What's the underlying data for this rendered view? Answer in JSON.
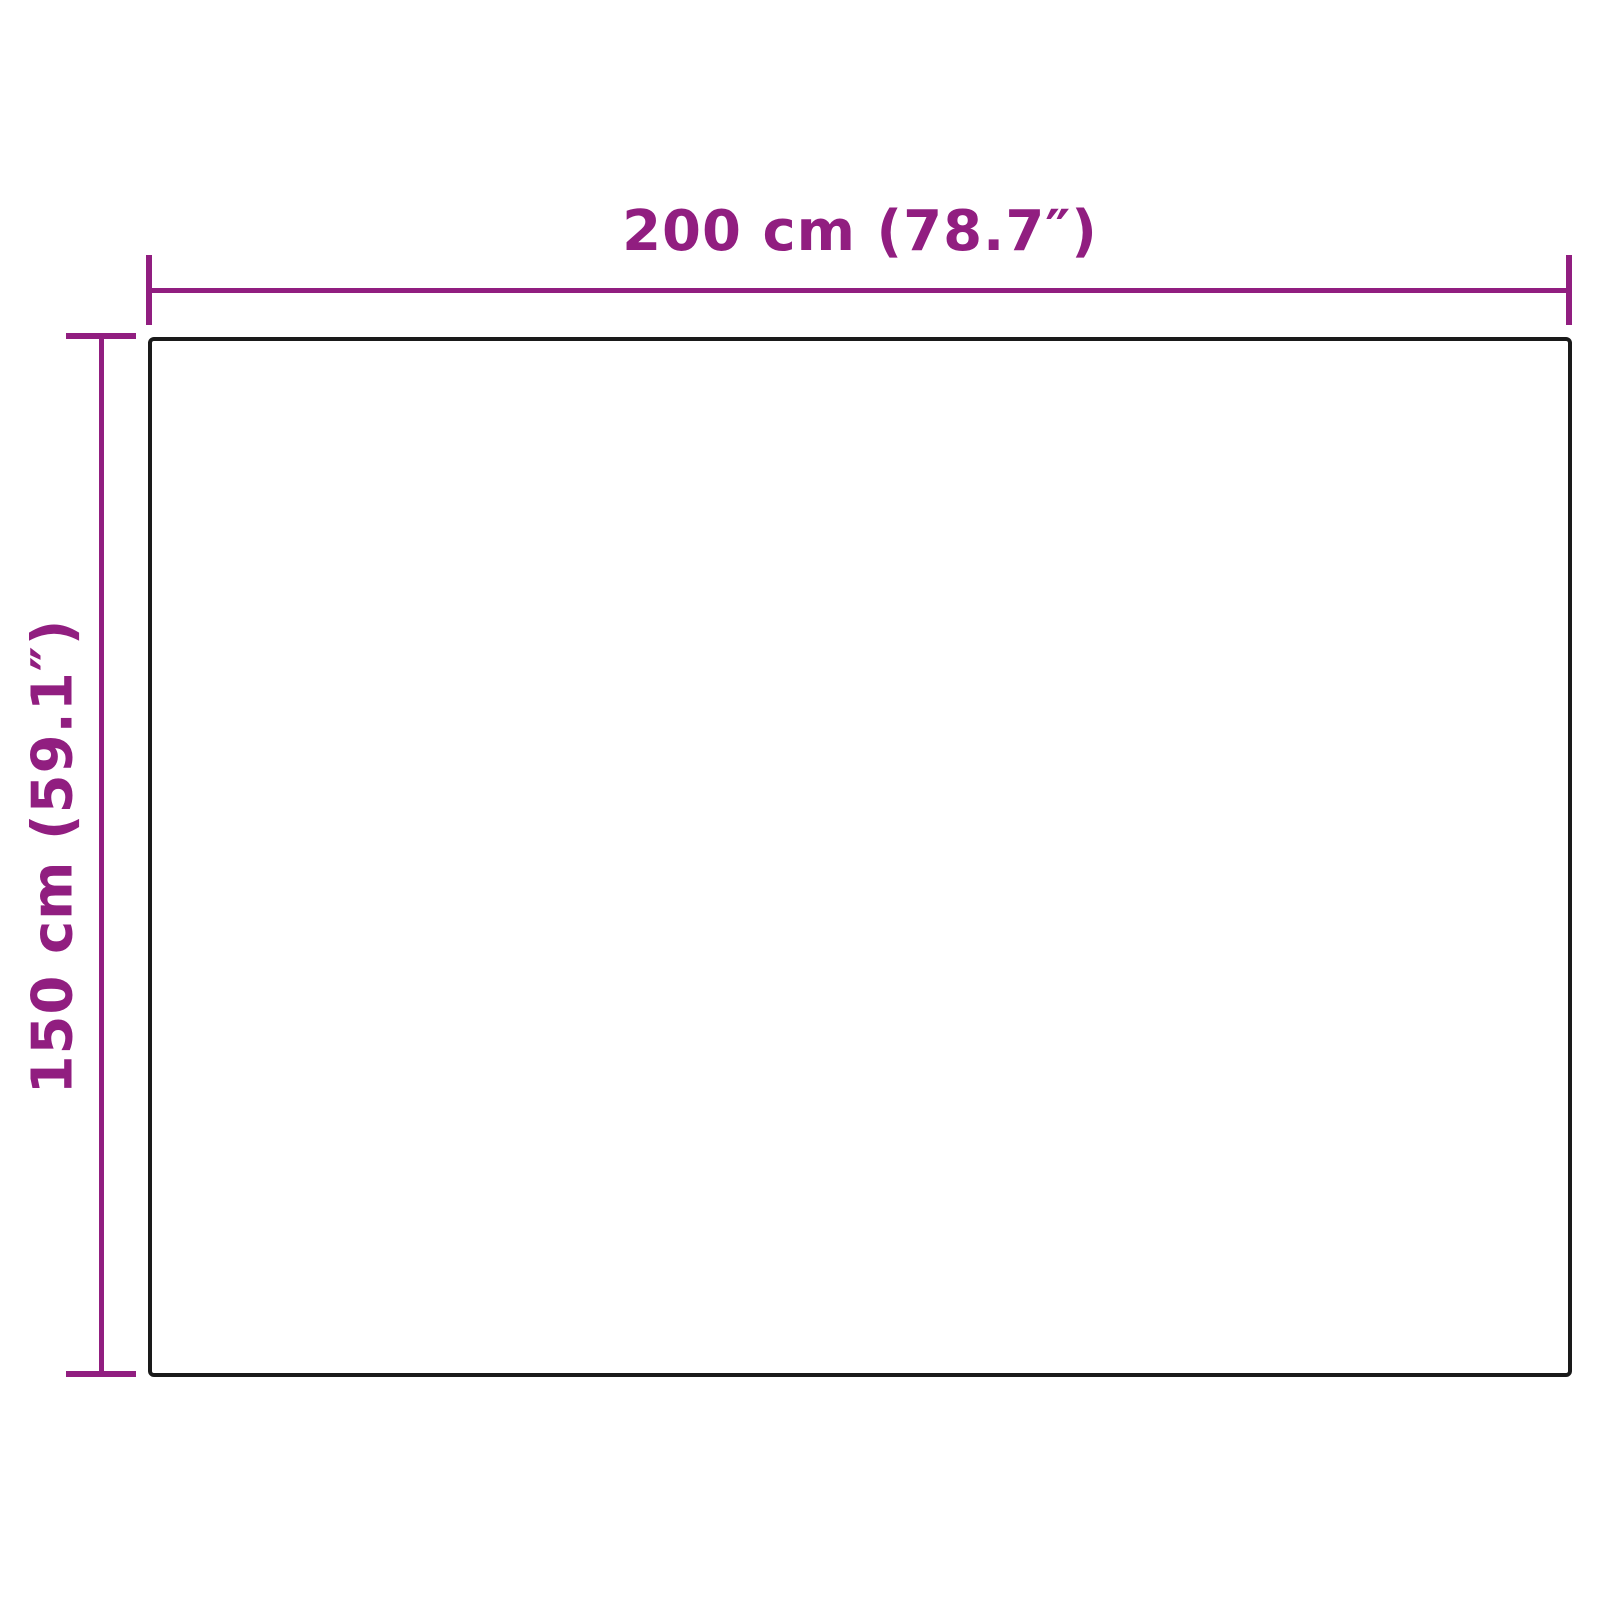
{
  "diagram": {
    "type": "product-dimension-diagram",
    "width_dimension": {
      "label": "200 cm (78.7″)",
      "value_cm": 200,
      "value_inches": 78.7
    },
    "height_dimension": {
      "label": "150 cm (59.1″)",
      "value_cm": 150,
      "value_inches": 59.1
    },
    "colors": {
      "accent": "#911e80",
      "outline": "#1a1a1a",
      "background": "#ffffff"
    }
  }
}
